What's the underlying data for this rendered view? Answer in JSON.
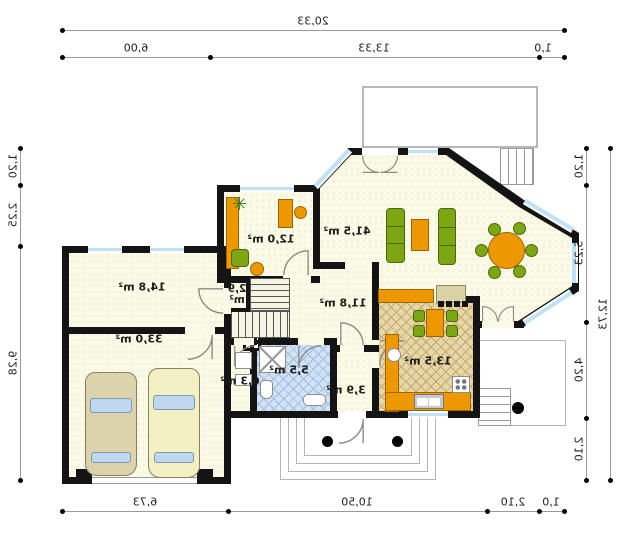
{
  "floor_plan": {
    "title": "mirrored house ground-floor plan",
    "rooms": [
      {
        "id": "study",
        "area_label": "12,0 m²"
      },
      {
        "id": "living-room",
        "area_label": "41,5 m²"
      },
      {
        "id": "room-above-garage",
        "area_label": "14,8 m²"
      },
      {
        "id": "garage",
        "area_label": "33,0 m²"
      },
      {
        "id": "stair-closet",
        "area_label": "2,9 m²"
      },
      {
        "id": "hall",
        "area_label": "11,8 m²"
      },
      {
        "id": "bathroom",
        "area_label": "5,5 m²"
      },
      {
        "id": "utility",
        "area_label": "6,3 m²"
      },
      {
        "id": "entry",
        "area_label": "3,9 m²"
      },
      {
        "id": "kitchen",
        "area_label": "13,5 m²"
      }
    ],
    "dimensions": {
      "top": {
        "total": "20,33",
        "segments": [
          "6,00",
          "13,33",
          "1,0"
        ]
      },
      "bottom": {
        "segments": [
          "6,73",
          "10,50",
          "2,10",
          "1,0"
        ]
      },
      "left": {
        "segments": [
          "1,20",
          "2,25",
          "9,28"
        ]
      },
      "right": {
        "segments": [
          "1,20",
          "5,23",
          "4,20",
          "2,10"
        ],
        "total": "12,73"
      }
    },
    "colors": {
      "wall": "#141414",
      "floor": "#FAFAE6",
      "window": "#BFE2F8",
      "furniture_orange": "#EE9800",
      "furniture_green": "#7CA713",
      "bathroom_floor": "#D2E2F5",
      "kitchen_floor": "#E6D7A8"
    }
  }
}
